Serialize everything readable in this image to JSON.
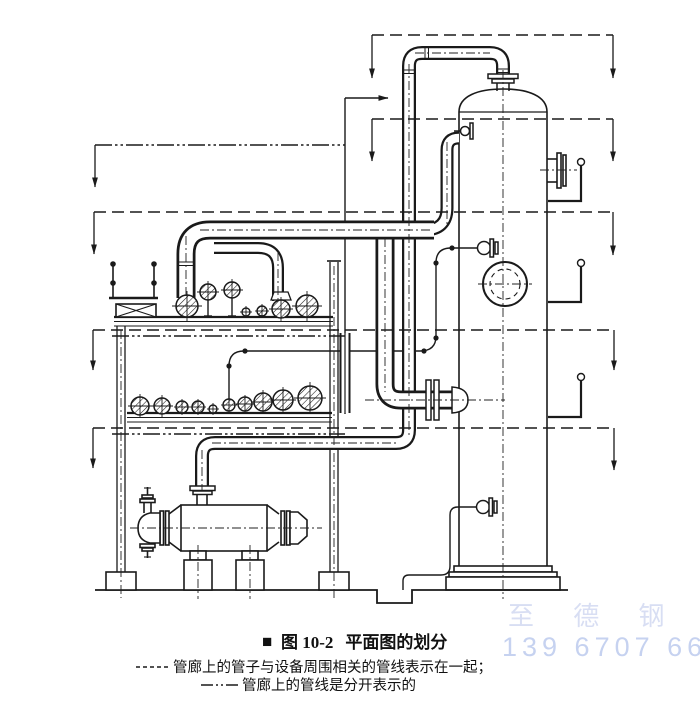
{
  "caption": {
    "bullet": "■",
    "figure_label": "图 10-2",
    "figure_title": "平面图的划分"
  },
  "legend": {
    "items": [
      {
        "line_style": "dashed",
        "text": "管廊上的管子与设备周围相关的管线表示在一起；"
      },
      {
        "line_style": "dash-dot-dot",
        "text": "管廊上的管线是分开表示的"
      }
    ]
  },
  "watermark": {
    "company": "至 德 钢 业",
    "phone": "139 6707 6667",
    "color": "#ccd6ef"
  },
  "colors": {
    "ink": "#1a1a1a",
    "background": "#ffffff"
  },
  "diagram": {
    "type": "piping-plan-division-elevation",
    "components": [
      "vertical-column-vessel",
      "pipe-rack-two-levels",
      "horizontal-heat-exchanger",
      "overhead-pipe-line",
      "rack-pipe-cross-sections",
      "section-division-boundary-arrows"
    ]
  }
}
